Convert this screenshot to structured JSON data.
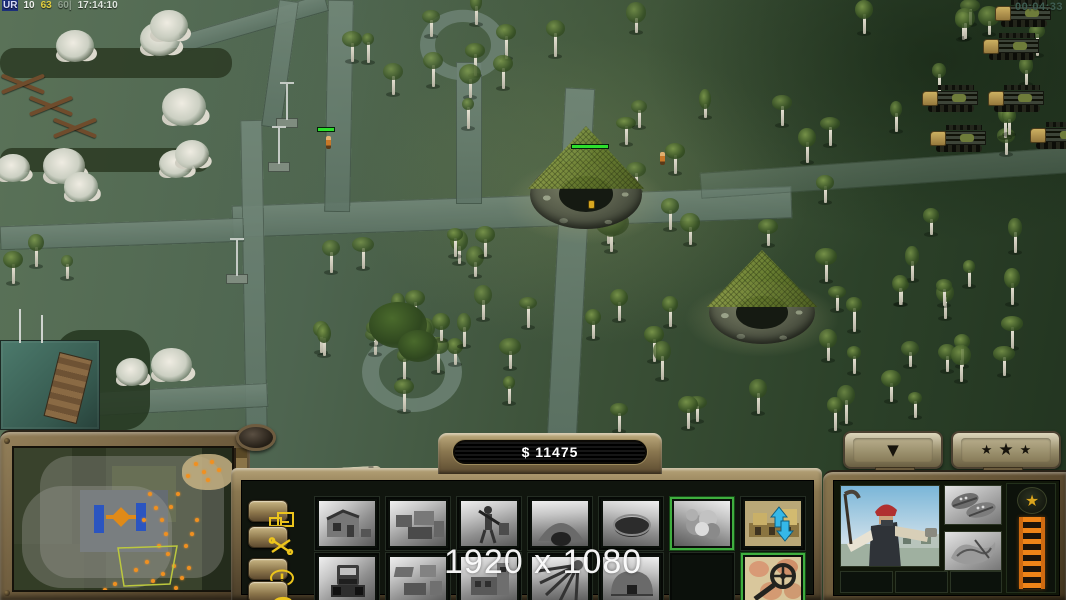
{
  "hud": {
    "debug_overlay": {
      "segments": [
        {
          "text": "UR",
          "color": "#d8dcf8",
          "bg": "#1c2f7a"
        },
        {
          "text": "10",
          "color": "#f0f2ee",
          "bg": ""
        },
        {
          "text": "63",
          "color": "#e3cf3e",
          "bg": ""
        },
        {
          "text": "60|",
          "color": "#8fa08f",
          "bg": ""
        },
        {
          "text": "17:14:10",
          "color": "#dfe6df",
          "bg": ""
        }
      ]
    },
    "match_timer": "00:04:33",
    "resolution_watermark": "1920 x 1080"
  },
  "control_bar": {
    "money_display": "$ 11475",
    "command_buttons": [
      {
        "name": "structures-button",
        "icon": "structures-icon"
      },
      {
        "name": "repair-button",
        "icon": "crossed-tools-icon"
      },
      {
        "name": "alert-button",
        "icon": "exclamation-icon"
      },
      {
        "name": "horn-button",
        "icon": "horn-icon"
      }
    ],
    "build_grid": {
      "rows": 2,
      "cols": 7,
      "cells": [
        {
          "row": 0,
          "col": 0,
          "type": "gray",
          "glyph": "ruined-house",
          "name": "build-item-ruined-house",
          "selected": false
        },
        {
          "row": 0,
          "col": 1,
          "type": "gray",
          "glyph": "building-cluster",
          "name": "build-item-compound",
          "selected": false
        },
        {
          "row": 0,
          "col": 2,
          "type": "gray",
          "glyph": "worker-figure",
          "name": "build-item-worker",
          "selected": false
        },
        {
          "row": 0,
          "col": 3,
          "type": "gray",
          "glyph": "cave",
          "name": "build-item-cave",
          "selected": false
        },
        {
          "row": 0,
          "col": 4,
          "type": "gray",
          "glyph": "dark-hole",
          "name": "build-item-hole",
          "selected": false
        },
        {
          "row": 0,
          "col": 5,
          "type": "gray",
          "glyph": "explosion",
          "name": "build-item-explosion",
          "selected": true
        },
        {
          "row": 0,
          "col": 6,
          "type": "color",
          "glyph": "structure-updown-arrows",
          "name": "build-item-structure-arrows",
          "selected": false
        },
        {
          "row": 1,
          "col": 0,
          "type": "gray",
          "glyph": "truck-front",
          "name": "build-item-truck",
          "selected": false
        },
        {
          "row": 1,
          "col": 1,
          "type": "gray",
          "glyph": "compound-iso",
          "name": "build-item-buildings",
          "selected": false
        },
        {
          "row": 1,
          "col": 2,
          "type": "gray",
          "glyph": "tower-building",
          "name": "build-item-tower",
          "selected": false
        },
        {
          "row": 1,
          "col": 3,
          "type": "gray",
          "glyph": "radial-beams",
          "name": "build-item-beams",
          "selected": false
        },
        {
          "row": 1,
          "col": 4,
          "type": "gray",
          "glyph": "dome-bunker",
          "name": "build-item-dome",
          "selected": false
        },
        {
          "row": 1,
          "col": 5,
          "type": "empty",
          "glyph": "",
          "name": "build-slot-empty",
          "selected": false
        },
        {
          "row": 1,
          "col": 6,
          "type": "color",
          "glyph": "magnifier-map",
          "name": "build-item-map-scan",
          "selected": true
        }
      ]
    }
  },
  "minimap": {
    "fog_color": "rgba(160,160,154,0.35)",
    "blue_bars": [
      [
        80,
        57,
        10,
        28
      ],
      [
        122,
        55,
        10,
        28
      ]
    ],
    "center_marker": {
      "x": 100,
      "y": 62,
      "color": "#e08a18"
    },
    "camera_frustum": {
      "points": "104,100 163,98 156,136 110,138",
      "color": "#bcc83e"
    },
    "sand_patch": {
      "x": 168,
      "y": 6,
      "w": 52,
      "h": 36,
      "color": "#c6b284"
    },
    "unit_dot_color": "#f09020",
    "unit_dots": [
      [
        134,
        44
      ],
      [
        140,
        58
      ],
      [
        146,
        70
      ],
      [
        150,
        84
      ],
      [
        143,
        96
      ],
      [
        152,
        104
      ],
      [
        158,
        116
      ],
      [
        147,
        124
      ],
      [
        166,
        128
      ],
      [
        173,
        118
      ],
      [
        160,
        138
      ],
      [
        137,
        131
      ],
      [
        170,
        96
      ],
      [
        176,
        84
      ],
      [
        181,
        70
      ],
      [
        172,
        26
      ],
      [
        180,
        14
      ],
      [
        188,
        22
      ],
      [
        196,
        12
      ],
      [
        203,
        20
      ],
      [
        192,
        30
      ],
      [
        155,
        57
      ],
      [
        162,
        44
      ],
      [
        128,
        70
      ],
      [
        120,
        120
      ],
      [
        131,
        112
      ],
      [
        99,
        134
      ],
      [
        89,
        140
      ]
    ]
  },
  "right_panel": {
    "collapse_button": {
      "glyph": "▼",
      "name": "collapse-button"
    },
    "rank_button": {
      "star_char": "★",
      "star_count": 3,
      "name": "rank-button"
    },
    "portrait": {
      "name": "worker-portrait"
    },
    "upgrades": [
      {
        "glyph": "shoes",
        "name": "upgrade-shoes"
      },
      {
        "glyph": "cloth",
        "name": "upgrade-cloth"
      }
    ],
    "xp_meter": {
      "star_icon": "rank-star-icon",
      "bar_color": "#ef8418"
    },
    "empty_slots": 3
  },
  "scene": {
    "bunkers": [
      {
        "x": 524,
        "y": 126,
        "w": 124,
        "h": 112,
        "health_bar": true,
        "barrel": true
      },
      {
        "x": 703,
        "y": 250,
        "w": 118,
        "h": 102,
        "health_bar": false,
        "barrel": false
      }
    ],
    "bunker_health_bar": {
      "x": 571,
      "y": 144,
      "w": 38,
      "fill": 1.0
    },
    "trucks": [
      [
        983,
        33
      ],
      [
        922,
        85
      ],
      [
        988,
        85
      ],
      [
        930,
        125
      ],
      [
        1030,
        122
      ],
      [
        995,
        0
      ]
    ],
    "soldiers": [
      [
        660,
        152
      ],
      [
        326,
        136
      ]
    ],
    "soldier_health_bar": {
      "x": 317,
      "y": 127,
      "w": 18,
      "fill": 1.0
    },
    "lampposts": [
      [
        276,
        82
      ],
      [
        268,
        126
      ],
      [
        226,
        238
      ]
    ],
    "tree_regions": [
      {
        "x0": 548,
        "x1": 1048,
        "y0": 8,
        "y1": 415,
        "count": 62,
        "kind": "birch",
        "seed": 7
      },
      {
        "x0": 300,
        "x1": 545,
        "y0": 238,
        "y1": 418,
        "count": 24,
        "kind": "birch",
        "seed": 11
      },
      {
        "x0": 338,
        "x1": 528,
        "y0": 2,
        "y1": 112,
        "count": 11,
        "kind": "birch",
        "seed": 3
      },
      {
        "x0": 8,
        "x1": 252,
        "y0": 22,
        "y1": 205,
        "count": 9,
        "kind": "flower",
        "seed": 5
      },
      {
        "x0": 120,
        "x1": 182,
        "y0": 328,
        "y1": 378,
        "count": 2,
        "kind": "flower",
        "seed": 9
      },
      {
        "x0": 2,
        "x1": 115,
        "y0": 232,
        "y1": 322,
        "count": 3,
        "kind": "birch",
        "seed": 13
      }
    ],
    "big_trees": [
      [
        398,
        328,
        58
      ],
      [
        596,
        203,
        44
      ],
      [
        612,
        224,
        34
      ],
      [
        418,
        348,
        40
      ]
    ]
  }
}
